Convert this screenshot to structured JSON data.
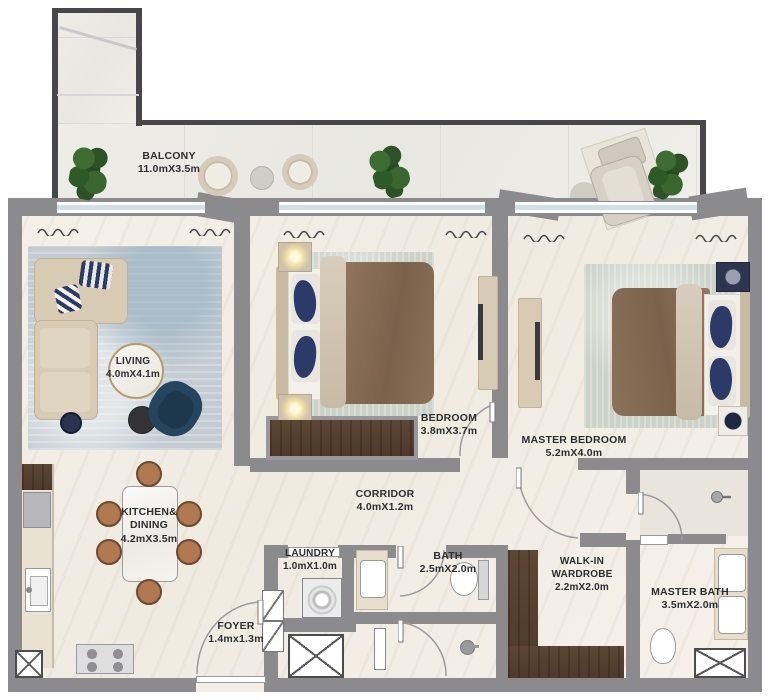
{
  "plan": {
    "type": "apartment-floor-plan",
    "rooms": [
      {
        "id": "balcony",
        "name": "BALCONY",
        "dims": "11.0mX3.5m"
      },
      {
        "id": "living",
        "name": "LIVING",
        "dims": "4.0mX4.1m"
      },
      {
        "id": "bedroom",
        "name": "BEDROOM",
        "dims": "3.8mX3.7m"
      },
      {
        "id": "master-bedroom",
        "name": "MASTER BEDROOM",
        "dims": "5.2mX4.0m"
      },
      {
        "id": "corridor",
        "name": "CORRIDOR",
        "dims": "4.0mX1.2m"
      },
      {
        "id": "kitchen-dining",
        "name": "KITCHEN& DINING",
        "dims": "4.2mX3.5m"
      },
      {
        "id": "laundry",
        "name": "LAUNDRY",
        "dims": "1.0mX1.0m"
      },
      {
        "id": "bath",
        "name": "BATH",
        "dims": "2.5mX2.0m"
      },
      {
        "id": "walk-in-wardrobe",
        "name": "WALK-IN WARDROBE",
        "dims": "2.2mX2.0m"
      },
      {
        "id": "master-bath",
        "name": "MASTER BATH",
        "dims": "3.5mX2.0m"
      },
      {
        "id": "foyer",
        "name": "FOYER",
        "dims": "1.4mx1.3m"
      }
    ],
    "colors": {
      "wall": "#8b8b8e",
      "balcony_wall": "#47474b",
      "floor": "#f3efe7",
      "label_text": "#2e2e30",
      "rug_blue": "#c3ccd2",
      "rug_sage": "#cbd2c8",
      "sofa_beige": "#d8cbb4",
      "duvet_brown": "#8a7057",
      "pillow_navy": "#2b3a66",
      "wood_dark": "#54402f",
      "plant_green": "#2f5b2b",
      "dining_chair_brown": "#a9714f"
    }
  }
}
